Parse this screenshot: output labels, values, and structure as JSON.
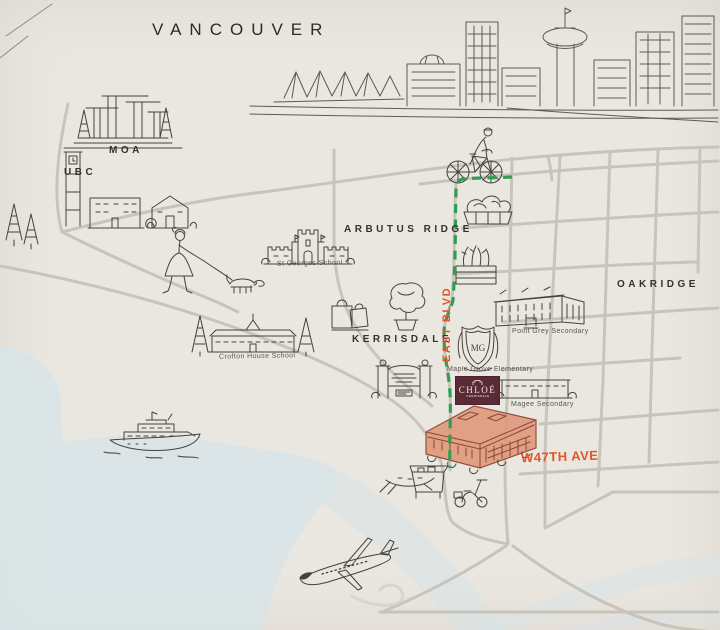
{
  "title": {
    "city": "VANCOUVER"
  },
  "labels": {
    "moa": "MOA",
    "ubc": "UBC",
    "arbutus_ridge": "ARBUTUS RIDGE",
    "kerrisdale": "KERRISDALE",
    "oakridge": "OAKRIDGE",
    "st_georges": "St Georges School",
    "crofton_house": "Crofton House School",
    "point_grey": "Point Grey Secondary",
    "maple_grove": "Maple Grove Elementary",
    "magee": "Magee Secondary"
  },
  "streets": {
    "east_blvd": "EAST BLVD",
    "w47th_ave": "W47TH AVE"
  },
  "logo": {
    "name": "CHLOÉ",
    "subtitle": "KERRISDALE",
    "crest_initials": "MG"
  },
  "route": {
    "color": "#2f9e53",
    "style": "dashed"
  },
  "colors": {
    "paper": "#eae7e0",
    "ink": "#45423c",
    "road_gray": "#c7c3b9",
    "water_blue": "#d7e3e7",
    "accent_orange": "#e25525",
    "route_green": "#2f9e53",
    "logo_maroon": "#5a2a36",
    "building_red": "#e09a7e"
  },
  "icons": [
    "skyline-illustration",
    "canada-place-sails-icon",
    "harbour-centre-tower-icon",
    "moa-building-icon",
    "ubc-clock-tower-icon",
    "campus-buildings-icon",
    "cyclist-icon",
    "dog-walker-icon",
    "st-georges-school-icon",
    "crofton-house-school-icon",
    "point-grey-secondary-icon",
    "maple-grove-crest-icon",
    "magee-secondary-icon",
    "chloe-building-icon",
    "kerrisdale-gate-icon",
    "shopping-bags-icon",
    "topiary-icon",
    "garden-planter-icon",
    "yacht-icon",
    "rowboat-icon",
    "market-cart-icon",
    "scooter-icon",
    "airplane-icon",
    "pine-trees-icon"
  ]
}
